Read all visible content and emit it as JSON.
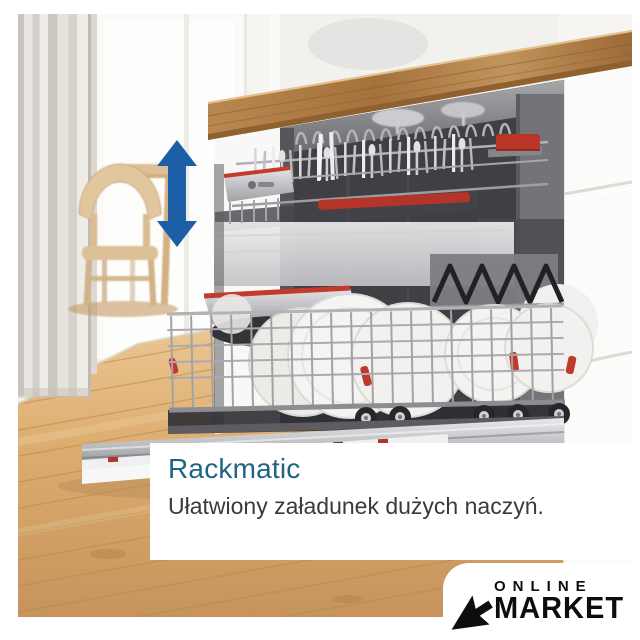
{
  "overlay": {
    "title": "Rackmatic",
    "subtitle": "Ułatwiony załadunek dużych naczyń.",
    "title_color": "#1f6485",
    "subtitle_color": "#3a3a3a",
    "background": "#ffffff"
  },
  "logo": {
    "line1": "ONLINE",
    "line2": "MARKET",
    "icon": "cursor-arrow-icon",
    "color": "#0d0d0d",
    "background": "#ffffff"
  },
  "scene": {
    "subject": "open built-in dishwasher with pulled-out racks of dishes in a kitchen",
    "arrow_icon": "double-vertical-arrow-icon",
    "arrow_color": "#1d5fa6",
    "accent_red": "#b93527",
    "counter_wood_color": "#a06c38",
    "floor_wood_color": "#d6a567"
  }
}
